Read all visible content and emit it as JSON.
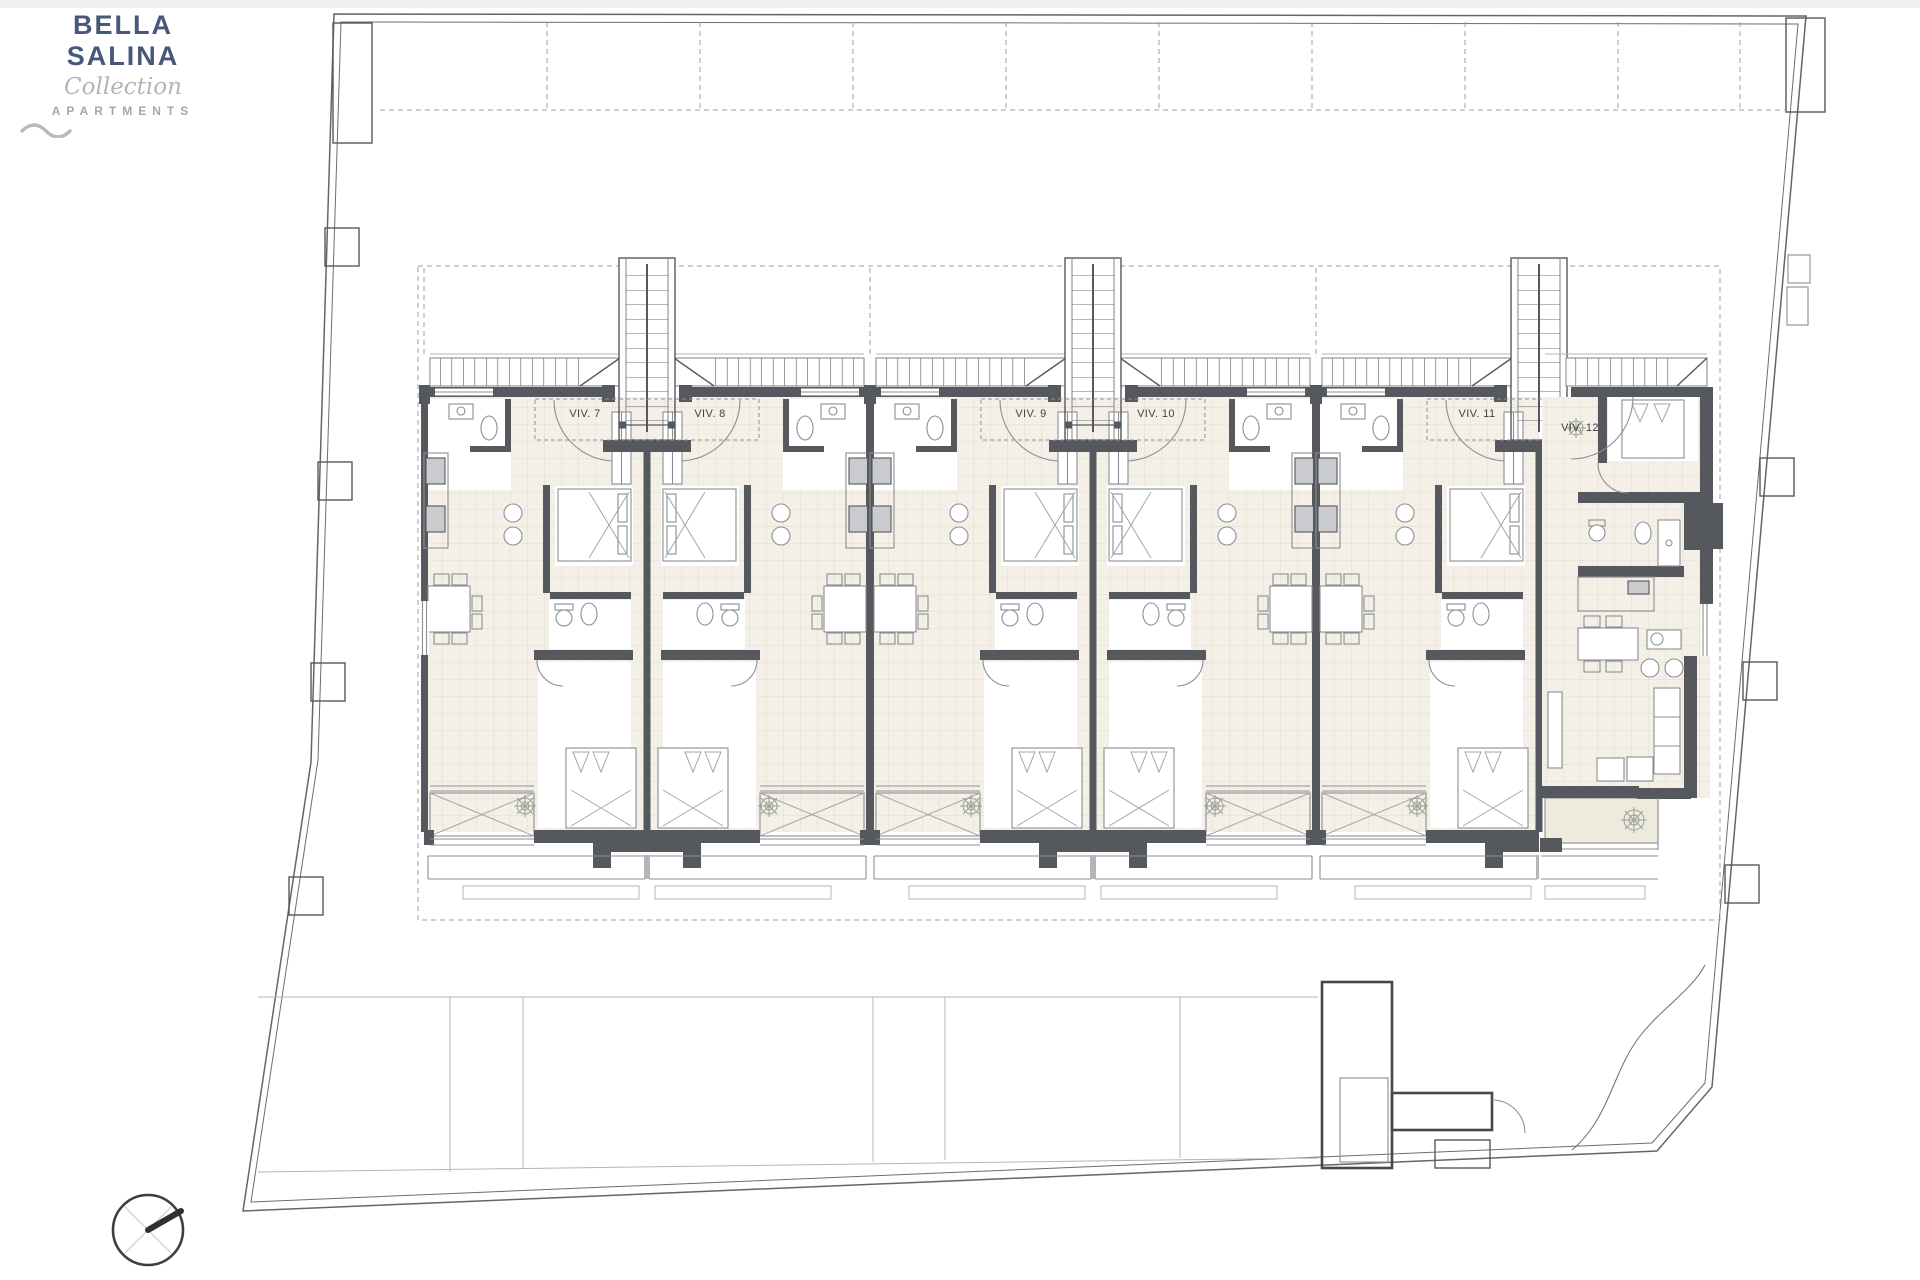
{
  "logo": {
    "brand": "BELLA SALINA",
    "collection": "Collection",
    "apartments": "APARTMENTS",
    "wave_icon": "wave-squiggle-icon",
    "brand_color": "#47587a",
    "muted_color": "#a2a9b1"
  },
  "plan": {
    "title": "first-floor site plan",
    "units": [
      {
        "id": "viv-7",
        "label": "VIV. 7"
      },
      {
        "id": "viv-8",
        "label": "VIV. 8"
      },
      {
        "id": "viv-9",
        "label": "VIV. 9"
      },
      {
        "id": "viv-10",
        "label": "VIV. 10"
      },
      {
        "id": "viv-11",
        "label": "VIV. 11"
      },
      {
        "id": "viv-12",
        "label": "VIV. 12"
      }
    ],
    "colors": {
      "wall": "#55585c",
      "thin_line": "#8b8e93",
      "light_line": "#b2b5b9",
      "boundary": "#63666a",
      "floor": "#f4f0e7",
      "floor_grid": "#e1dccc",
      "label_text": "#3f4247"
    },
    "compass": "north-arrow"
  }
}
